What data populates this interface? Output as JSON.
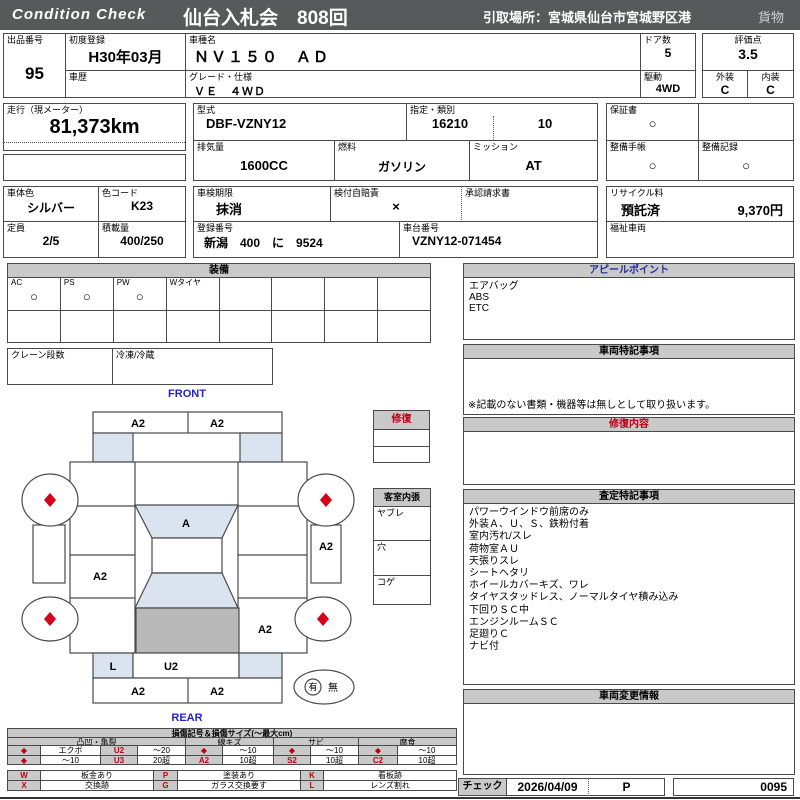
{
  "header": {
    "logo": "Condition  Check",
    "auction": "仙台入札会　808回",
    "pickup": "引取場所：宮城県仙台市宮城野区港",
    "cargo": "貨物"
  },
  "info": {
    "lot_label": "出品番号",
    "lot": "95",
    "first_reg_label": "初度登録",
    "first_reg": "H30年03月",
    "history_label": "車歴",
    "history": "",
    "model_label": "車種名",
    "model": "ＮＶ１５０　ＡＤ",
    "grade_label": "グレード・仕様",
    "grade": "ＶＥ　４ＷＤ",
    "doors_label": "ドア数",
    "doors": "5",
    "drive_label": "駆動",
    "drive": "4WD",
    "score_label": "評価点",
    "score": "3.5",
    "ext_label": "外装",
    "ext": "C",
    "int_label": "内装",
    "int": "C",
    "mileage_label": "走行（現メーター）",
    "mileage": "81,373km",
    "type_label": "型式",
    "type": "DBF-VZNY12",
    "class_label": "指定・類別",
    "class1": "16210",
    "class2": "10",
    "disp_label": "排気量",
    "disp": "1600CC",
    "fuel_label": "燃料",
    "fuel": "ガソリン",
    "mission_label": "ミッション",
    "mission": "AT",
    "warranty_label": "保証書",
    "warranty": "○",
    "book_label": "整備手帳",
    "book": "○",
    "record_label": "整備記録",
    "record": "○",
    "color_label": "車体色",
    "color": "シルバー",
    "colorcode_label": "色コード",
    "colorcode": "K23",
    "inspection_label": "車検期限",
    "inspection": "抹消",
    "jibaiseki_label": "検付自賠責",
    "jibaiseki": "×",
    "approval_label": "承認請求書",
    "approval": "",
    "recycle_label": "リサイクル料",
    "recycle_status": "預託済",
    "recycle_fee": "9,370円",
    "capacity_label": "定員",
    "capacity": "2/5",
    "load_label": "積載量",
    "load": "400/250",
    "regno_label": "登録番号",
    "regno": "新潟　400　に　9524",
    "chassis_label": "車台番号",
    "chassis": "VZNY12-071454",
    "welfare_label": "福祉車両",
    "welfare": ""
  },
  "equipment": {
    "header": "装備",
    "labels": [
      "AC",
      "PS",
      "PW",
      "Wタイヤ",
      "",
      "",
      "",
      ""
    ],
    "marks": [
      "○",
      "○",
      "○",
      "",
      "",
      "",
      "",
      ""
    ],
    "crane_label": "クレーン段数",
    "crane": "",
    "reefer_label": "冷凍/冷蔵",
    "reefer": ""
  },
  "diagram": {
    "front": "FRONT",
    "rear": "REAR",
    "labels": {
      "fb_l": "A2",
      "fb_r": "A2",
      "windshield": "A",
      "sill_r": "A2",
      "door_rl": "A2",
      "quarter_r": "A2",
      "rear_l": "L",
      "rear_c": "U2",
      "rb_l": "A2",
      "rb_r": "A2"
    },
    "spare_yes": "有",
    "spare_no": "無"
  },
  "repair_box": {
    "header": "修復"
  },
  "interior_box": {
    "header": "客室内張",
    "items": [
      "ヤブレ",
      "穴",
      "コゲ"
    ]
  },
  "right": {
    "appeal": {
      "header": "アピールポイント",
      "lines": [
        "エアバッグ",
        "ABS",
        "ETC"
      ]
    },
    "notes": {
      "header": "車両特記事項",
      "footnote": "※記載のない書類・機器等は無しとして取り扱います。"
    },
    "repair": {
      "header": "修復内容"
    },
    "assessment": {
      "header": "査定特記事項",
      "lines": [
        "パワーウインドウ前席のみ",
        "外装Ａ、Ｕ、Ｓ、鉄粉付着",
        "室内汚れ/スレ",
        "荷物室ＡＵ",
        "天張りスレ",
        "シートヘタリ",
        "ホイールカバーキズ、ワレ",
        "タイヤスタッドレス、ノーマルタイヤ積み込み",
        "下回りＳＣ中",
        "エンジンルームＳＣ",
        "足廻りＣ",
        "ナビ付"
      ]
    },
    "change": {
      "header": "車両変更情報"
    },
    "check": {
      "label": "チェック",
      "date": "2026/04/09",
      "mark": "P",
      "number": "0095"
    }
  },
  "legend": {
    "title": "損傷記号＆損傷サイズ(〜最大cm)",
    "groups": [
      "凸凹・亀裂",
      "線キズ",
      "サビ",
      "腐食"
    ],
    "row1": [
      "◆",
      "エクボ",
      "U2",
      "〜20",
      "◆",
      "〜10",
      "◆",
      "〜10",
      "◆",
      "〜10"
    ],
    "row2": [
      "◆",
      "〜10",
      "U3",
      "20超",
      "A2",
      "10超",
      "S2",
      "10超",
      "C2",
      "10超"
    ],
    "codes_row1": [
      "W",
      "板金あり",
      "P",
      "塗装あり",
      "K",
      "看板跡"
    ],
    "codes_row2": [
      "X",
      "交換跡",
      "G",
      "ガラス交換要す",
      "L",
      "レンズ割れ"
    ]
  },
  "colors": {
    "accent_red": "#c00016",
    "accent_blue": "#2222cc",
    "bar_gray": "#58595b",
    "panel_blue": "#d9e4f0",
    "panel_gray": "#b9b9b9"
  }
}
